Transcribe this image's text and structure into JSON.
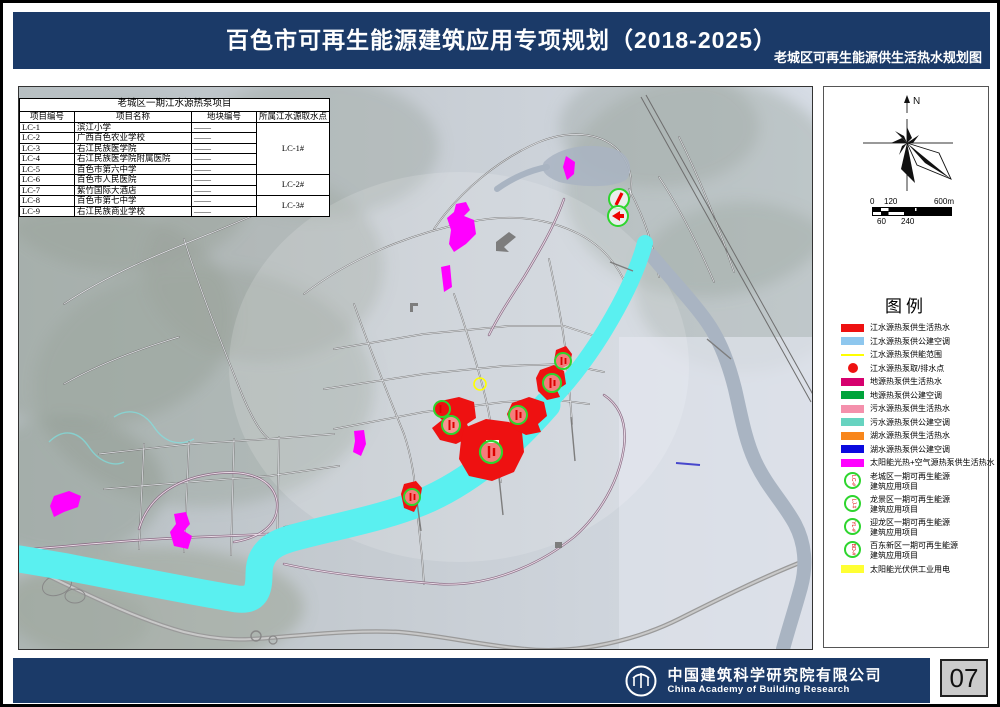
{
  "header": {
    "title": "百色市可再生能源建筑应用专项规划（2018-2025）",
    "subtitle": "老城区可再生能源供生活热水规划图"
  },
  "table": {
    "title": "老城区一期江水源热泵项目",
    "columns": [
      "项目编号",
      "项目名称",
      "地块编号",
      "所属江水源取水点"
    ],
    "rows": [
      {
        "code": "LC-1",
        "name": "滨江小学",
        "plot": "——"
      },
      {
        "code": "LC-2",
        "name": "广西百色农业学校",
        "plot": "——"
      },
      {
        "code": "LC-3",
        "name": "右江民族医学院",
        "plot": "——"
      },
      {
        "code": "LC-4",
        "name": "右江民族医学院附属医院",
        "plot": "——"
      },
      {
        "code": "LC-5",
        "name": "百色市第六中学",
        "plot": "——"
      },
      {
        "code": "LC-6",
        "name": "百色市人民医院",
        "plot": "——"
      },
      {
        "code": "LC-7",
        "name": "紫竹国际大酒店",
        "plot": "——"
      },
      {
        "code": "LC-8",
        "name": "百色市第七中学",
        "plot": "——"
      },
      {
        "code": "LC-9",
        "name": "右江民族商业学校",
        "plot": "——"
      }
    ],
    "intake_groups": [
      {
        "label": "LC-1#",
        "rows": 5
      },
      {
        "label": "LC-2#",
        "rows": 2
      },
      {
        "label": "LC-3#",
        "rows": 2
      }
    ]
  },
  "compass": {
    "north_label": "N"
  },
  "scalebar": {
    "labels_top": [
      "0",
      "120",
      "600m"
    ],
    "labels_bottom": [
      "60",
      "240"
    ]
  },
  "legend": {
    "title": "图例",
    "items": [
      {
        "kind": "swatch",
        "color": "#ee1111",
        "label": "江水源热泵供生活热水"
      },
      {
        "kind": "swatch",
        "color": "#8ec7ee",
        "label": "江水源热泵供公建空调"
      },
      {
        "kind": "line",
        "color": "#ffff00",
        "label": "江水源热泵供能范围"
      },
      {
        "kind": "dot",
        "color": "#ee1111",
        "label": "江水源热泵取/排水点"
      },
      {
        "kind": "swatch",
        "color": "#d6006e",
        "label": "地源热泵供生活热水"
      },
      {
        "kind": "swatch",
        "color": "#00a43b",
        "label": "地源热泵供公建空调"
      },
      {
        "kind": "swatch",
        "color": "#f490ac",
        "label": "污水源热泵供生活热水"
      },
      {
        "kind": "swatch",
        "color": "#67d3c0",
        "label": "污水源热泵供公建空调"
      },
      {
        "kind": "swatch",
        "color": "#f8861b",
        "label": "湖水源热泵供生活热水"
      },
      {
        "kind": "swatch",
        "color": "#0a0adf",
        "label": "湖水源热泵供公建空调"
      },
      {
        "kind": "swatch",
        "color": "#ff00ff",
        "label": "太阳能光热+空气源热泵供生活热水"
      },
      {
        "kind": "marker",
        "icon_label": "LC-#",
        "label": "老城区一期可再生能源",
        "label2": "建筑应用项目"
      },
      {
        "kind": "marker",
        "icon_label": "LJ-#",
        "label": "龙景区一期可再生能源",
        "label2": "建筑应用项目"
      },
      {
        "kind": "marker",
        "icon_label": "YL-#",
        "label": "迎龙区一期可再生能源",
        "label2": "建筑应用项目"
      },
      {
        "kind": "marker",
        "icon_label": "BD-#",
        "label": "百东新区一期可再生能源",
        "label2": "建筑应用项目"
      },
      {
        "kind": "swatch",
        "color": "#ffff33",
        "label": "太阳能光伏供工业用电"
      }
    ]
  },
  "footer": {
    "company_cn": "中国建筑科学研究院有限公司",
    "company_en": "China Academy of Building Research"
  },
  "page": {
    "number": "07"
  },
  "colors": {
    "header_bg": "#1b3a68",
    "river_highlight": "#5af0f0",
    "zone_red": "#ee1111",
    "zone_magenta": "#ff00ff",
    "marker_ring_green": "#2ed52e"
  }
}
